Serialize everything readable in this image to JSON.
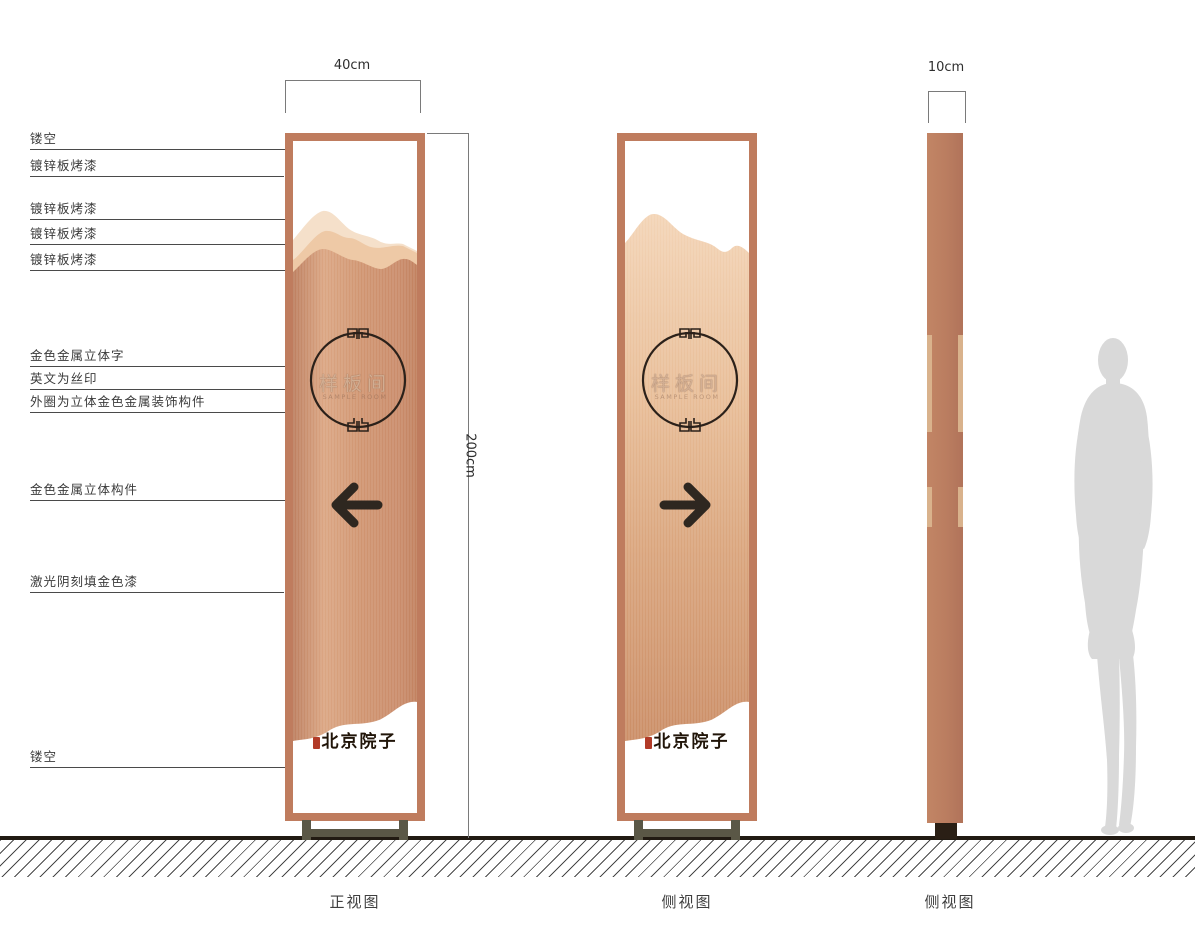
{
  "drawing": {
    "callouts": [
      "镂空",
      "镀锌板烤漆",
      "镀锌板烤漆",
      "镀锌板烤漆",
      "镀锌板烤漆",
      "金色金属立体字",
      "英文为丝印",
      "外圈为立体金色金属装饰构件",
      "金色金属立体构件",
      "激光阴刻填金色漆",
      "镂空"
    ],
    "dimensions": {
      "front_width": "40cm",
      "height": "200cm",
      "side_width": "10cm"
    },
    "sign": {
      "plaque_text": "样板间",
      "plaque_subtext": "SAMPLE ROOM",
      "brand_text": "北京院子"
    },
    "views": [
      "正视图",
      "侧视图",
      "侧视图"
    ],
    "colors": {
      "copper_frame": "#bf7c5e",
      "panel_copper": "#cf9470",
      "panel_light": "#f0cba9",
      "mountain_light": "#f5e0ca",
      "mountain_mid": "#eec9a6",
      "detail_dark": "#2e2620",
      "seal_red": "#b23b28",
      "base_olive": "#5a5746",
      "silhouette_gray": "#d9d9d9"
    }
  }
}
